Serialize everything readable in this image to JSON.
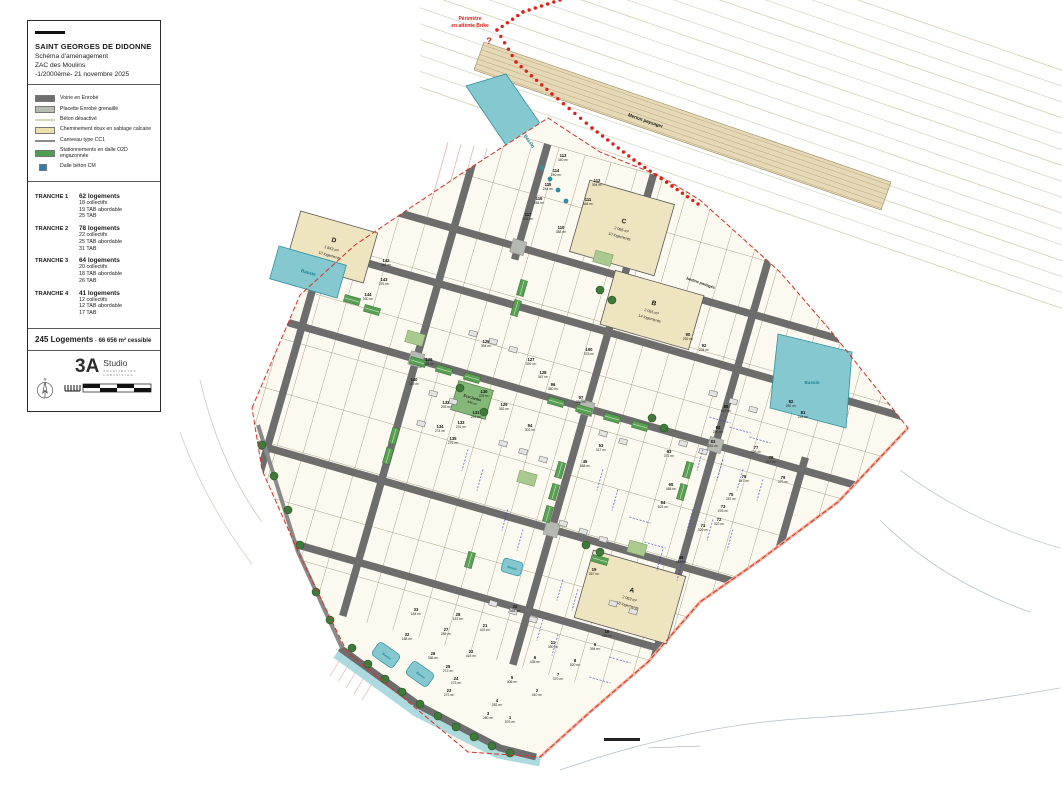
{
  "title_block": {
    "commune": "SAINT GEORGES DE DIDONNE",
    "subtitle": "Schéma d'aménagement",
    "project": "ZAC des Moulins",
    "scale_date": "-1/2000ème- 21 novembre 2025"
  },
  "legend": [
    {
      "label": "Voirie en Enrobé",
      "swatch": "rect",
      "color": "#6e6e6e"
    },
    {
      "label": "Placette Enrobé grenaillé",
      "swatch": "rect",
      "color": "#b7bcb4"
    },
    {
      "label": "Béton désactivé",
      "swatch": "line",
      "color": "#d8d5bd"
    },
    {
      "label": "Cheminement doux en sablage calcaire",
      "swatch": "rect",
      "color": "#ecdfae"
    },
    {
      "label": "Caniveau type CC1",
      "swatch": "line",
      "color": "#8b8b8b"
    },
    {
      "label": "Stationnements en dalle O2D engazonnée",
      "swatch": "grid",
      "color": "#4f9e50"
    },
    {
      "label": "Dalle béton CM",
      "swatch": "small",
      "color": "#2e7fae"
    }
  ],
  "tranches": [
    {
      "name": "TRANCHE 1",
      "total": "62 logements",
      "details": [
        "18 collectifs",
        "19 TAB abordable",
        "25 TAB"
      ]
    },
    {
      "name": "TRANCHE 2",
      "total": "78 logements",
      "details": [
        "22 collectifs",
        "25 TAB abordable",
        "31 TAB"
      ]
    },
    {
      "name": "TRANCHE 3",
      "total": "64 logements",
      "details": [
        "20 collectifs",
        "18 TAB abordable",
        "26 TAB"
      ]
    },
    {
      "name": "TRANCHE 4",
      "total": "41 logements",
      "details": [
        "12 collectifs",
        "12 TAB abordable",
        "17 TAB"
      ]
    }
  ],
  "summary": {
    "count": "245 Logements",
    "sep": "-",
    "area": "66 656 m² cessible"
  },
  "logo": {
    "mark": "3A",
    "name": "Studio",
    "tagline": "ARCHITECTES URBANISTES",
    "north": "N"
  },
  "map": {
    "note": {
      "line1": "Périmètre",
      "line2": "en attente Brike",
      "q": "?"
    },
    "labels": {
      "merlon": "Merlon paysager",
      "jardins": "Jardins partagés",
      "ecojardin": "Eco'Jardin",
      "ecojardin_area": "946 m²",
      "bassin": "Bassin"
    },
    "collectives": [
      {
        "id": "A",
        "area": "2 063 m²",
        "units": "18 logements"
      },
      {
        "id": "B",
        "area": "2 055 m²",
        "units": "14 logements"
      },
      {
        "id": "C",
        "area": "2 066 m²",
        "units": "10 logements"
      },
      {
        "id": "D",
        "area": "1 843 m²",
        "units": "10 logements"
      }
    ],
    "lots": [
      {
        "n": "113",
        "a": "340 m²",
        "x": 563,
        "y": 157
      },
      {
        "n": "112",
        "a": "394 m²",
        "x": 597,
        "y": 182
      },
      {
        "n": "111",
        "a": "464 m²",
        "x": 588,
        "y": 201
      },
      {
        "n": "114",
        "a": "240 m²",
        "x": 556,
        "y": 172
      },
      {
        "n": "115",
        "a": "244 m²",
        "x": 548,
        "y": 186
      },
      {
        "n": "116",
        "a": "284 m²",
        "x": 539,
        "y": 200
      },
      {
        "n": "117",
        "a": "401 m²",
        "x": 528,
        "y": 216
      },
      {
        "n": "110",
        "a": "388 m²",
        "x": 561,
        "y": 229
      },
      {
        "n": "142",
        "a": "346 m²",
        "x": 386,
        "y": 262
      },
      {
        "n": "143",
        "a": "376 m²",
        "x": 384,
        "y": 281
      },
      {
        "n": "144",
        "a": "330 m²",
        "x": 368,
        "y": 296
      },
      {
        "n": "125",
        "a": "394 m²",
        "x": 486,
        "y": 343
      },
      {
        "n": "126",
        "a": "394 m²",
        "x": 429,
        "y": 361
      },
      {
        "n": "127",
        "a": "392 m²",
        "x": 531,
        "y": 361
      },
      {
        "n": "128",
        "a": "367 m²",
        "x": 543,
        "y": 374
      },
      {
        "n": "129",
        "a": "382 m²",
        "x": 504,
        "y": 406
      },
      {
        "n": "130",
        "a": "376 m²",
        "x": 484,
        "y": 393
      },
      {
        "n": "131",
        "a": "291 m²",
        "x": 476,
        "y": 414
      },
      {
        "n": "132",
        "a": "293 m²",
        "x": 446,
        "y": 404
      },
      {
        "n": "133",
        "a": "231 m²",
        "x": 461,
        "y": 424
      },
      {
        "n": "134",
        "a": "274 m²",
        "x": 440,
        "y": 428
      },
      {
        "n": "135",
        "a": "276 m²",
        "x": 453,
        "y": 440
      },
      {
        "n": "140",
        "a": "375 m²",
        "x": 414,
        "y": 381
      },
      {
        "n": "100",
        "a": "378 m²",
        "x": 589,
        "y": 351
      },
      {
        "n": "96",
        "a": "350 m²",
        "x": 553,
        "y": 386
      },
      {
        "n": "97",
        "a": "386 m²",
        "x": 581,
        "y": 399
      },
      {
        "n": "94",
        "a": "302 m²",
        "x": 530,
        "y": 427
      },
      {
        "n": "53",
        "a": "317 m²",
        "x": 601,
        "y": 447
      },
      {
        "n": "45",
        "a": "458 m²",
        "x": 585,
        "y": 463
      },
      {
        "n": "90",
        "a": "292 m²",
        "x": 688,
        "y": 336
      },
      {
        "n": "92",
        "a": "294 m²",
        "x": 704,
        "y": 347
      },
      {
        "n": "88",
        "a": "427 m²",
        "x": 726,
        "y": 408
      },
      {
        "n": "84",
        "a": "280 m²",
        "x": 718,
        "y": 429
      },
      {
        "n": "83",
        "a": "281 m²",
        "x": 713,
        "y": 443
      },
      {
        "n": "82",
        "a": "281 m²",
        "x": 791,
        "y": 403
      },
      {
        "n": "81",
        "a": "249 m²",
        "x": 803,
        "y": 414
      },
      {
        "n": "77",
        "a": "428 m²",
        "x": 756,
        "y": 449
      },
      {
        "n": "78",
        "a": "427 m²",
        "x": 771,
        "y": 459
      },
      {
        "n": "79",
        "a": "379 m²",
        "x": 783,
        "y": 479
      },
      {
        "n": "76",
        "a": "347 m²",
        "x": 744,
        "y": 478
      },
      {
        "n": "75",
        "a": "287 m²",
        "x": 731,
        "y": 496
      },
      {
        "n": "73",
        "a": "293 m²",
        "x": 723,
        "y": 508
      },
      {
        "n": "72",
        "a": "322 m²",
        "x": 719,
        "y": 521
      },
      {
        "n": "71",
        "a": "320 m²",
        "x": 703,
        "y": 527
      },
      {
        "n": "65",
        "a": "458 m²",
        "x": 671,
        "y": 486
      },
      {
        "n": "64",
        "a": "522 m²",
        "x": 663,
        "y": 504
      },
      {
        "n": "63",
        "a": "371 m²",
        "x": 669,
        "y": 453
      },
      {
        "n": "49",
        "a": "484 m²",
        "x": 681,
        "y": 559
      },
      {
        "n": "19",
        "a": "267 m²",
        "x": 594,
        "y": 571
      },
      {
        "n": "33",
        "a": "184 m²",
        "x": 416,
        "y": 611
      },
      {
        "n": "32",
        "a": "188 m²",
        "x": 407,
        "y": 636
      },
      {
        "n": "28",
        "a": "187 m²",
        "x": 458,
        "y": 616
      },
      {
        "n": "27",
        "a": "285 m²",
        "x": 446,
        "y": 631
      },
      {
        "n": "26",
        "a": "336 m²",
        "x": 433,
        "y": 655
      },
      {
        "n": "21",
        "a": "423 m²",
        "x": 485,
        "y": 627
      },
      {
        "n": "22",
        "a": "415 m²",
        "x": 471,
        "y": 653
      },
      {
        "n": "25",
        "a": "272 m²",
        "x": 448,
        "y": 668
      },
      {
        "n": "24",
        "a": "273 m²",
        "x": 456,
        "y": 680
      },
      {
        "n": "23",
        "a": "272 m²",
        "x": 449,
        "y": 692
      },
      {
        "n": "20",
        "a": "365 m²",
        "x": 515,
        "y": 608
      },
      {
        "n": "11",
        "a": "390 m²",
        "x": 553,
        "y": 644
      },
      {
        "n": "10",
        "a": "435 m²",
        "x": 607,
        "y": 633
      },
      {
        "n": "9",
        "a": "394 m²",
        "x": 595,
        "y": 646
      },
      {
        "n": "8",
        "a": "520 m²",
        "x": 575,
        "y": 662
      },
      {
        "n": "7",
        "a": "370 m²",
        "x": 558,
        "y": 676
      },
      {
        "n": "6",
        "a": "435 m²",
        "x": 535,
        "y": 659
      },
      {
        "n": "5",
        "a": "406 m²",
        "x": 512,
        "y": 679
      },
      {
        "n": "2",
        "a": "410 m²",
        "x": 537,
        "y": 692
      },
      {
        "n": "4",
        "a": "282 m²",
        "x": 497,
        "y": 702
      },
      {
        "n": "3",
        "a": "280 m²",
        "x": 488,
        "y": 715
      },
      {
        "n": "1",
        "a": "576 m²",
        "x": 510,
        "y": 719
      }
    ]
  }
}
